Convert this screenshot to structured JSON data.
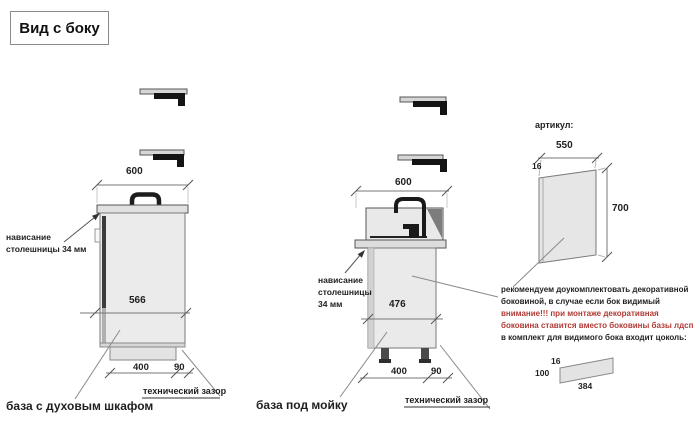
{
  "title": "Вид с боку",
  "colors": {
    "warning": "#b13a35",
    "ink": "#1f1f1f",
    "line": "#777777",
    "fill": "#eaeaea"
  },
  "cabinet1": {
    "label": "база с духовым шкафом",
    "dim_width": "600",
    "dim_depth": "566",
    "dim_plinth": "400",
    "dim_gap": "90",
    "overhang_line1": "нависание",
    "overhang_line2": "столешницы 34 мм",
    "gap_label": "технический зазор"
  },
  "cabinet2": {
    "label": "база под мойку",
    "dim_width": "600",
    "dim_depth": "476",
    "dim_plinth": "400",
    "dim_gap": "90",
    "overhang_line1": "нависание",
    "overhang_line2": "столешницы",
    "overhang_line3": "34 мм",
    "gap_label": "технический зазор"
  },
  "side_panel": {
    "heading": "артикул:",
    "dim_width": "550",
    "dim_thickness": "16",
    "dim_height": "700"
  },
  "note": {
    "black1": "рекомендуем доукомплектовать декоративной",
    "black2": "боковиной, в случае если бок видимый",
    "red1": "внимание!!! при монтаже декоративная",
    "red2": "боковина ставится вместо боковины базы лдсп",
    "black3": "в комплект для видимого бока входит цоколь:"
  },
  "plinth_strip": {
    "dim_thickness": "16",
    "dim_height": "100",
    "dim_length": "384"
  }
}
